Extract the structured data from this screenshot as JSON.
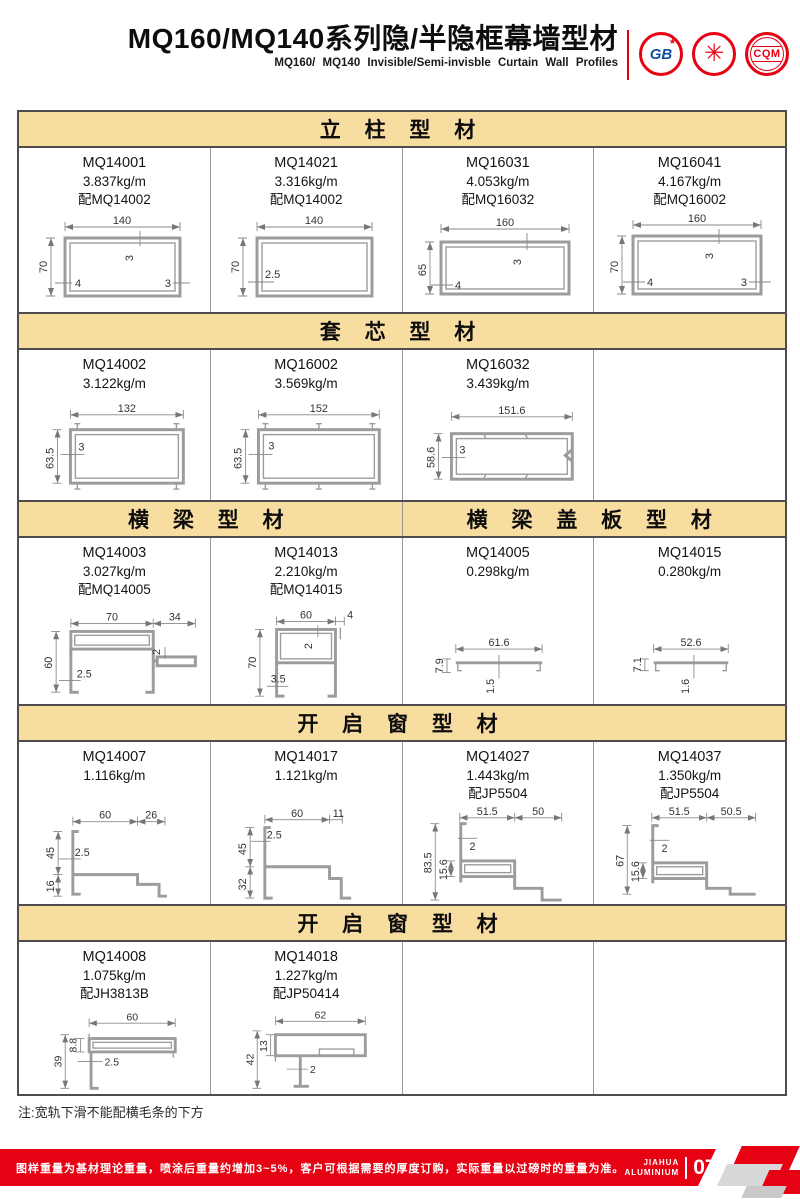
{
  "header": {
    "title": "MQ160/MQ140系列隐/半隐框幕墙型材",
    "subtitle": "MQ160/ MQ140 Invisible/Semi-invisble Curtain Wall Profiles",
    "logos": {
      "gb": "GB",
      "gb_star": "★",
      "seal_emblem": "✳",
      "cqm": "CQM"
    }
  },
  "sections": [
    {
      "title": "立 柱 型 材",
      "items": [
        {
          "code": "MQ14001",
          "weight": "3.837kg/m",
          "match": "配MQ14002",
          "dims": {
            "w": "140",
            "h": "70",
            "a": "3",
            "b": "4",
            "c": "3"
          }
        },
        {
          "code": "MQ14021",
          "weight": "3.316kg/m",
          "match": "配MQ14002",
          "dims": {
            "w": "140",
            "h": "70",
            "a": "2.5"
          }
        },
        {
          "code": "MQ16031",
          "weight": "4.053kg/m",
          "match": "配MQ16032",
          "dims": {
            "w": "160",
            "h": "65",
            "a": "3",
            "b": "4"
          }
        },
        {
          "code": "MQ16041",
          "weight": "4.167kg/m",
          "match": "配MQ16002",
          "dims": {
            "w": "160",
            "h": "70",
            "a": "3",
            "b": "4",
            "c": "3"
          }
        }
      ]
    },
    {
      "title": "套 芯 型 材",
      "items": [
        {
          "code": "MQ14002",
          "weight": "3.122kg/m",
          "dims": {
            "w": "132",
            "h": "63.5",
            "a": "3"
          }
        },
        {
          "code": "MQ16002",
          "weight": "3.569kg/m",
          "dims": {
            "w": "152",
            "h": "63.5",
            "a": "3"
          }
        },
        {
          "code": "MQ16032",
          "weight": "3.439kg/m",
          "dims": {
            "w": "151.6",
            "h": "58.6",
            "a": "3"
          }
        }
      ]
    },
    {
      "title_left": "横 梁 型 材",
      "title_right": "横 梁 盖 板 型 材",
      "items": [
        {
          "code": "MQ14003",
          "weight": "3.027kg/m",
          "match": "配MQ14005",
          "dims": {
            "w": "70",
            "w2": "34",
            "h": "60",
            "a": "2.5",
            "b": "2"
          }
        },
        {
          "code": "MQ14013",
          "weight": "2.210kg/m",
          "match": "配MQ14015",
          "dims": {
            "w": "60",
            "w2": "4",
            "h": "70",
            "a": "2",
            "b": "3.5"
          }
        },
        {
          "code": "MQ14005",
          "weight": "0.298kg/m",
          "dims": {
            "w": "61.6",
            "h": "7.9",
            "a": "1.5"
          }
        },
        {
          "code": "MQ14015",
          "weight": "0.280kg/m",
          "dims": {
            "w": "52.6",
            "h": "7.1",
            "a": "1.6"
          }
        }
      ]
    },
    {
      "title": "开 启 窗 型 材",
      "items": [
        {
          "code": "MQ14007",
          "weight": "1.116kg/m",
          "dims": {
            "w": "60",
            "w2": "26",
            "h": "45",
            "h2": "16",
            "a": "2.5"
          }
        },
        {
          "code": "MQ14017",
          "weight": "1.121kg/m",
          "dims": {
            "w": "60",
            "w2": "11",
            "h": "45",
            "h2": "32",
            "a": "2.5"
          }
        },
        {
          "code": "MQ14027",
          "weight": "1.443kg/m",
          "match": "配JP5504",
          "dims": {
            "w": "51.5",
            "w2": "50",
            "h": "83.5",
            "h2": "15.6",
            "a": "2"
          }
        },
        {
          "code": "MQ14037",
          "weight": "1.350kg/m",
          "match": "配JP5504",
          "dims": {
            "w": "51.5",
            "w2": "50.5",
            "h": "67",
            "h2": "15.6",
            "a": "2"
          }
        }
      ]
    },
    {
      "title": "开 启 窗 型 材",
      "items": [
        {
          "code": "MQ14008",
          "weight": "1.075kg/m",
          "match": "配JH3813B",
          "dims": {
            "w": "60",
            "h": "39",
            "h2": "8.8",
            "a": "2.5"
          }
        },
        {
          "code": "MQ14018",
          "weight": "1.227kg/m",
          "match": "配JP50414",
          "dims": {
            "w": "62",
            "h": "42",
            "h2": "13",
            "a": "2"
          }
        }
      ]
    }
  ],
  "note": "注:宽轨下滑不能配横毛条的下方",
  "footer": {
    "text": "图样重量为基材理论重量，喷涂后重量约增加3~5%，客户可根据需要的厚度订购，实际重量以过磅时的重量为准。",
    "brand_top": "JIAHUA",
    "brand_bottom": "ALUMINIUM",
    "page": "07"
  },
  "colors": {
    "band": "#f8dda1",
    "red": "#e60113",
    "border": "#4d4d4d",
    "profile": "#9c9c9c"
  }
}
